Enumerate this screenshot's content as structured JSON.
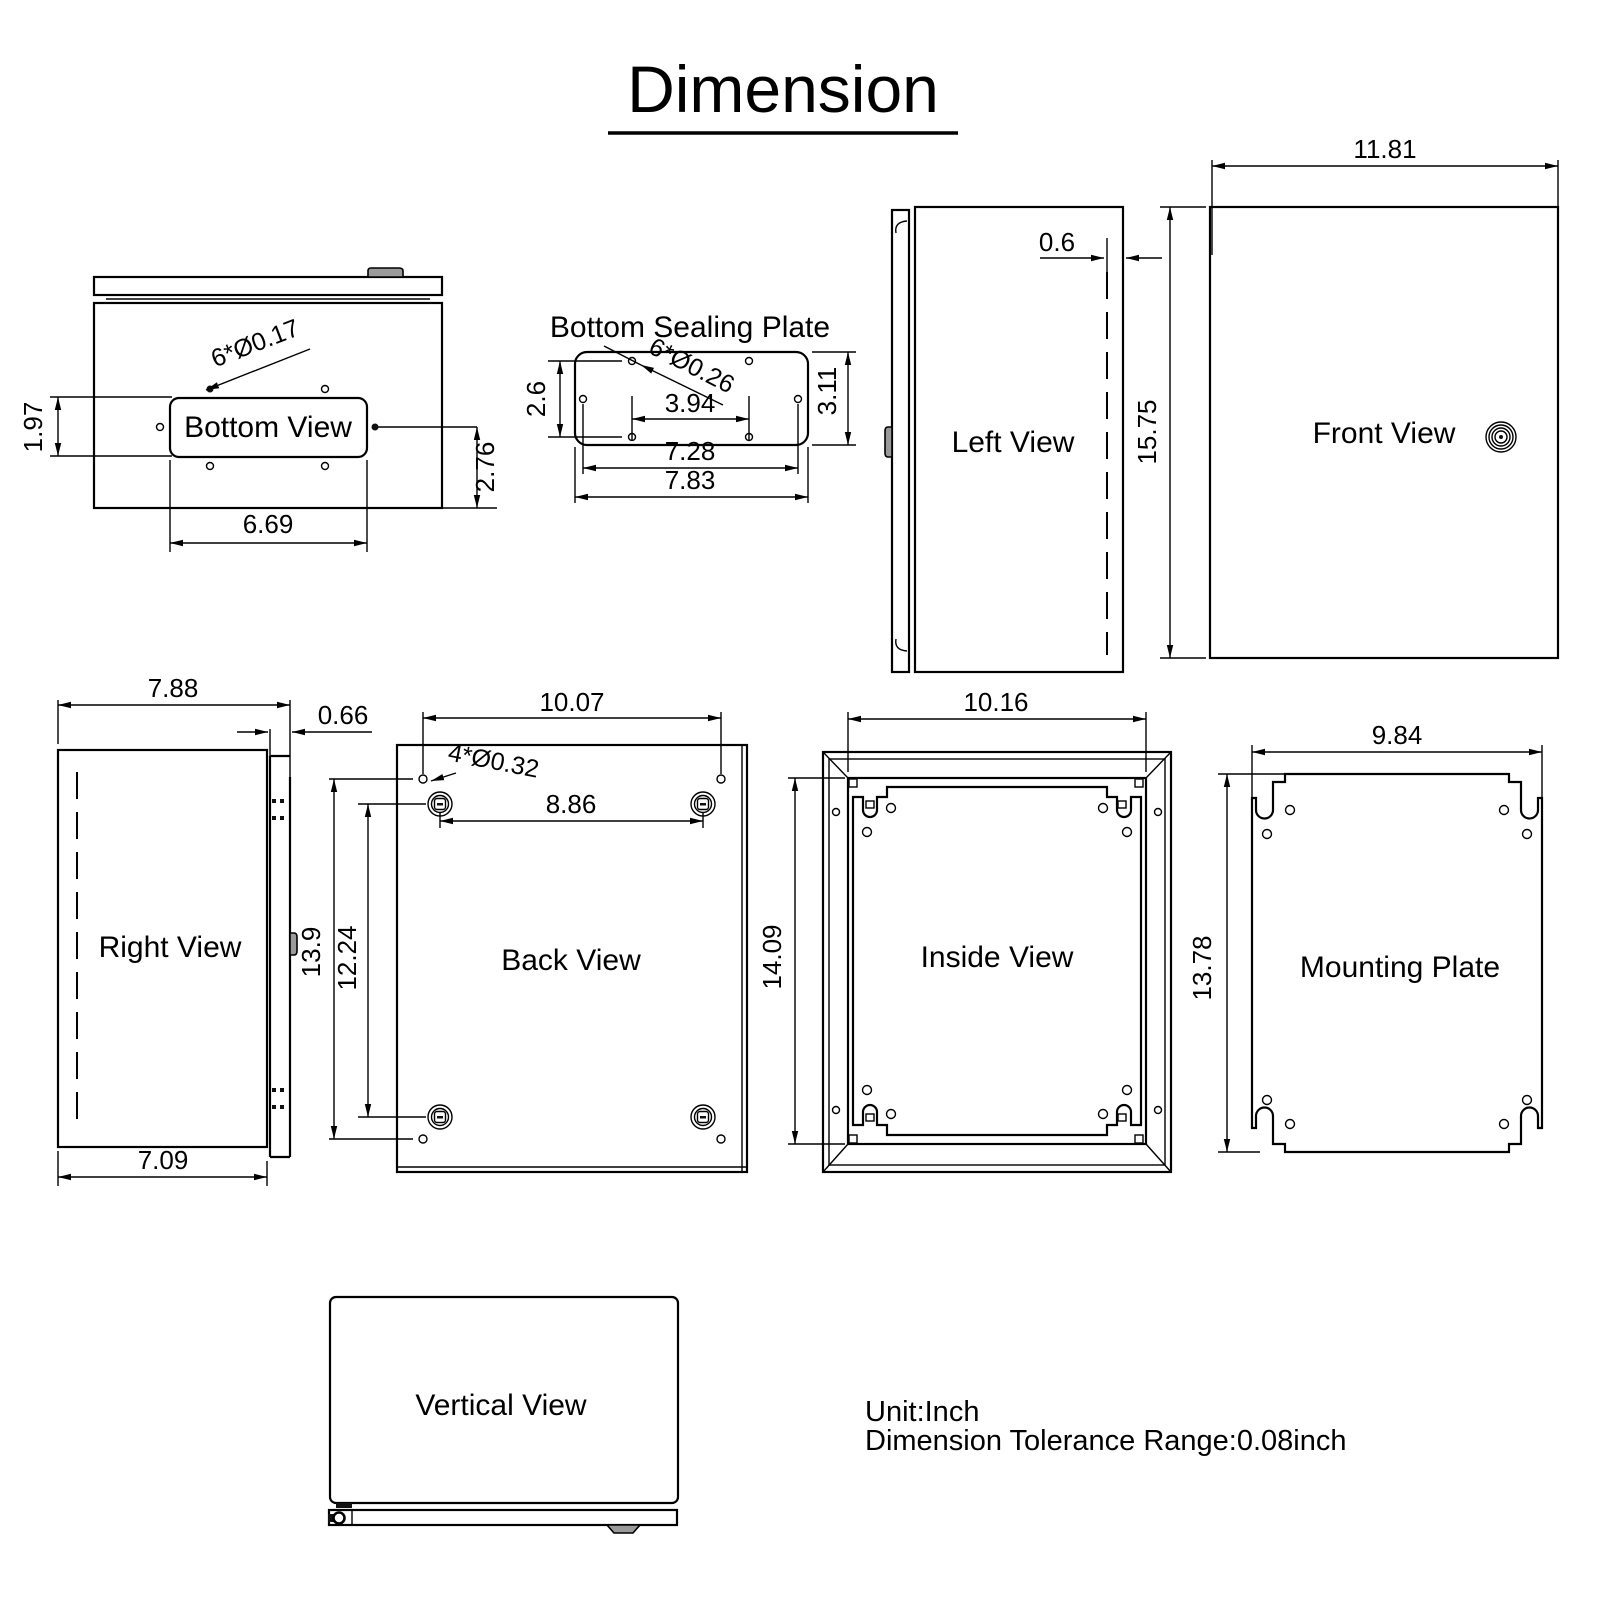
{
  "title": "Dimension",
  "notes": {
    "unit": "Unit:Inch",
    "tolerance": "Dimension Tolerance Range:0.08inch"
  },
  "views": {
    "bottom": {
      "label": "Bottom View",
      "hole_callout": "6*Ø0.17",
      "cutout_depth": "1.97",
      "side_offset": "2.76",
      "cutout_width": "6.69"
    },
    "sealing": {
      "label": "Bottom Sealing Plate",
      "hole_callout": "6*Ø0.26",
      "hole_gap_v": "2.6",
      "height": "3.11",
      "hole_gap_h": "3.94",
      "hole_span": "7.28",
      "width": "7.83"
    },
    "left": {
      "label": "Left View",
      "door_inset": "0.6"
    },
    "front": {
      "label": "Front View",
      "width": "11.81",
      "height": "15.75"
    },
    "right": {
      "label": "Right View",
      "width_total": "7.88",
      "door_thickness": "0.66",
      "body_width": "7.09"
    },
    "back": {
      "label": "Back View",
      "hole_callout": "4*Ø0.32",
      "hole_span_h": "10.07",
      "boss_span_h": "8.86",
      "hole_span_v": "13.9",
      "boss_span_v": "12.24"
    },
    "inside": {
      "label": "Inside View",
      "width": "10.16",
      "height": "14.09"
    },
    "mounting": {
      "label": "Mounting Plate",
      "width": "9.84",
      "height": "13.78"
    },
    "vertical": {
      "label": "Vertical View"
    }
  }
}
